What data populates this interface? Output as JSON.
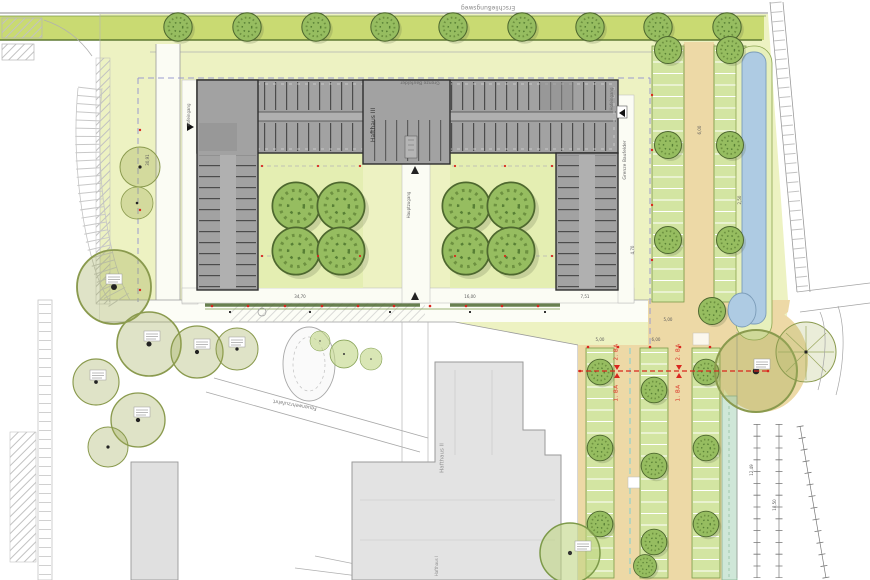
{
  "labels": {
    "street_top": "Erschließungsweg",
    "grenze": "Grenze Baufelder",
    "hafthaus3": "Hafthaus III",
    "hafthaus2": "Hafthaus II",
    "hafthaus1": "Hafthaus I",
    "hofeingang": "Hofeingang",
    "hauptzugang": "Hauptzugang",
    "feuerwehr": "Feuerwehrzufahrt",
    "phase1": "1. BA",
    "phase2": "2. BA"
  },
  "dims": [
    "30,91",
    "34,70",
    "16,00",
    "7,51",
    "5,00",
    "6,00",
    "2,50",
    "4,70",
    "12,49",
    "18,50",
    "5,00",
    "6,00"
  ],
  "colors": {
    "site_green": "#edf2c2",
    "verge_green": "#c9da72",
    "courtyard_green": "#e4eeb2",
    "stall_green": "#d3e5a2",
    "tree_green": "#96bd60",
    "building_dark": "#a2a2a2",
    "building_light": "#e3e3e3",
    "asphalt_tan": "#edd9a6",
    "water_blue": "#aecbe3",
    "canal_teal": "#cfe7d8",
    "phase_red": "#d9271e",
    "boundary_dash": "#9b9bd0"
  }
}
